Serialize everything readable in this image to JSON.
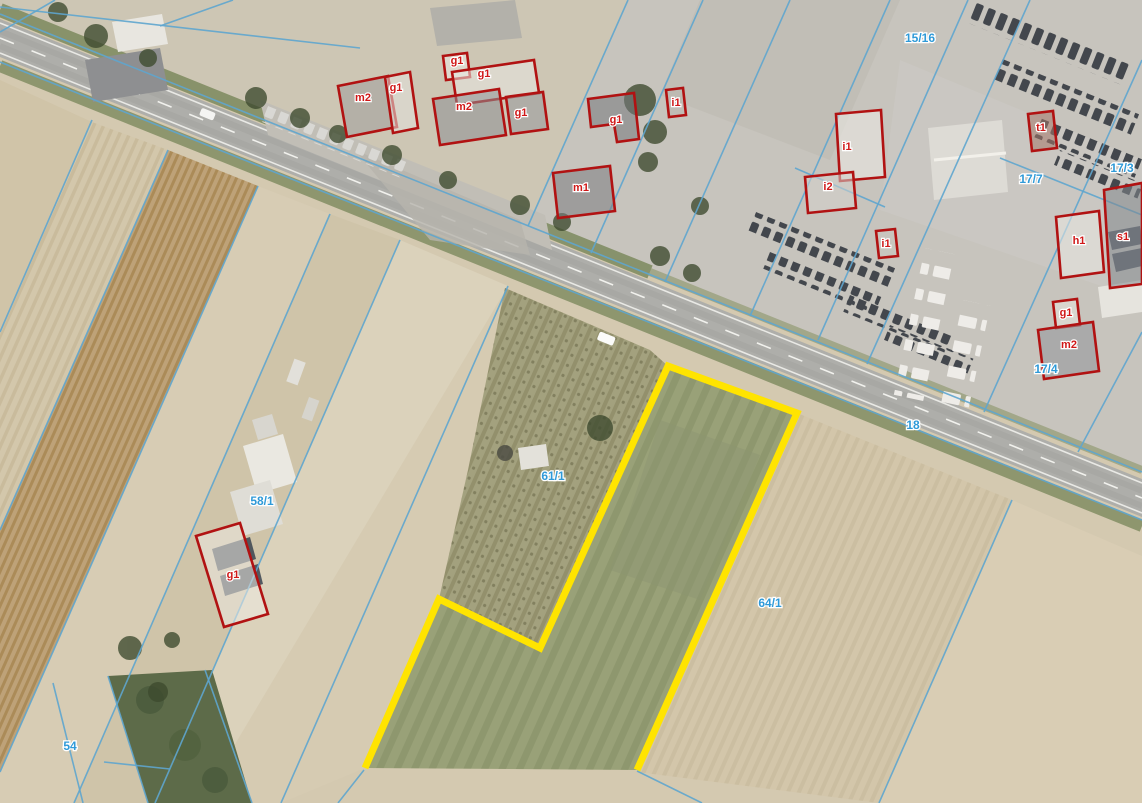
{
  "map": {
    "colors": {
      "parcel_line_blue": "#5fa6cf",
      "parcel_label_blue": "#2f9ad8",
      "building_outline_red": "#b11212",
      "building_label_red": "#d01818",
      "highlight_yellow": "#ffe400"
    },
    "parcel_labels": [
      {
        "text": "15/16",
        "x": 920,
        "y": 42
      },
      {
        "text": "17/7",
        "x": 1031,
        "y": 183
      },
      {
        "text": "17/3",
        "x": 1122,
        "y": 172
      },
      {
        "text": "17/4",
        "x": 1046,
        "y": 373
      },
      {
        "text": "18",
        "x": 913,
        "y": 429
      },
      {
        "text": "58/1",
        "x": 262,
        "y": 505
      },
      {
        "text": "61/1",
        "x": 553,
        "y": 480
      },
      {
        "text": "64/1",
        "x": 770,
        "y": 607
      },
      {
        "text": "54",
        "x": 70,
        "y": 750
      }
    ],
    "buildings": [
      {
        "label": "m2",
        "points": "338,86 388,76 397,127 347,137",
        "lx": 363,
        "ly": 101,
        "roof": "#a09f9d"
      },
      {
        "label": "g1",
        "points": "385,77 410,72 418,128 393,133",
        "lx": 396,
        "ly": 91,
        "roof": "#e4e2dc"
      },
      {
        "label": "g1",
        "points": "443,56 467,53 470,77 446,80",
        "lx": 457,
        "ly": 64,
        "roof": "#eceae4"
      },
      {
        "label": "g1",
        "points": "452,72 534,60 539,93 457,105",
        "lx": 484,
        "ly": 77,
        "roof": "#e9e7e1"
      },
      {
        "label": "m2",
        "points": "433,99 499,89 506,135 440,145",
        "lx": 464,
        "ly": 110,
        "roof": "#8e9093"
      },
      {
        "label": "g1",
        "points": "506,97 543,92 548,129 511,134",
        "lx": 521,
        "ly": 116,
        "roof": "#97999c"
      },
      {
        "label": "g1",
        "points": "588,99 634,93 639,139 617,142 614,124 591,127",
        "lx": 616,
        "ly": 123,
        "roof": "#75787c"
      },
      {
        "label": "m1",
        "points": "553,173 610,166 615,211 558,218",
        "lx": 581,
        "ly": 191,
        "roof": "#7b7e82"
      },
      {
        "label": "i1",
        "points": "666,90 683,88 686,115 669,117",
        "lx": 676,
        "ly": 106,
        "roof": "#b9b6af"
      },
      {
        "label": "i1",
        "points": "836,114 881,110 885,177 840,181",
        "lx": 847,
        "ly": 150,
        "roof": "#edebe6"
      },
      {
        "label": "i2",
        "points": "805,177 853,172 856,208 808,213",
        "lx": 828,
        "ly": 190,
        "roof": "#d4d2cc"
      },
      {
        "label": "i1",
        "points": "876,231 895,229 898,256 879,258",
        "lx": 886,
        "ly": 247,
        "roof": "#c9c6bf"
      },
      {
        "label": "t1",
        "points": "1028,114 1053,111 1057,148 1032,151",
        "lx": 1041,
        "ly": 131,
        "roof": "#a4766a"
      },
      {
        "label": "h1",
        "points": "1056,217 1099,211 1104,272 1061,278",
        "lx": 1079,
        "ly": 244,
        "roof": "#e9e7e2"
      },
      {
        "label": "s1",
        "points": "1104,190 1142,183 1142,284 1110,288",
        "lx": 1123,
        "ly": 240,
        "roof": "#82868d"
      },
      {
        "label": "g1",
        "points": "1053,302 1077,299 1080,325 1056,328",
        "lx": 1066,
        "ly": 316,
        "roof": "#e7e5df"
      },
      {
        "label": "m2",
        "points": "1038,330 1093,322 1099,371 1044,379",
        "lx": 1069,
        "ly": 348,
        "roof": "#92959a"
      },
      {
        "label": "g1",
        "points": "196,536 240,523 268,614 224,627",
        "lx": 233,
        "ly": 578,
        "roof": "#ece9e2"
      }
    ],
    "parcel_lines": [
      [
        0,
        14,
        1142,
        472
      ],
      [
        0,
        62,
        1142,
        520
      ],
      [
        55,
        0,
        0,
        32
      ],
      [
        233,
        0,
        160,
        26
      ],
      [
        0,
        7,
        360,
        48
      ],
      [
        92,
        120,
        0,
        332
      ],
      [
        168,
        150,
        0,
        530
      ],
      [
        258,
        186,
        0,
        772
      ],
      [
        330,
        214,
        74,
        803
      ],
      [
        400,
        240,
        155,
        803
      ],
      [
        508,
        286,
        281,
        803
      ],
      [
        628,
        0,
        528,
        226
      ],
      [
        703,
        0,
        591,
        253
      ],
      [
        790,
        0,
        665,
        282
      ],
      [
        890,
        0,
        750,
        316
      ],
      [
        968,
        0,
        818,
        340
      ],
      [
        1030,
        0,
        867,
        364
      ],
      [
        1142,
        60,
        984,
        412
      ],
      [
        1142,
        332,
        1078,
        452
      ],
      [
        795,
        168,
        885,
        207
      ],
      [
        1000,
        158,
        1142,
        215
      ],
      [
        1012,
        500,
        879,
        803
      ],
      [
        637,
        771,
        702,
        803
      ],
      [
        364,
        770,
        338,
        803
      ],
      [
        53,
        683,
        83,
        803
      ],
      [
        108,
        676,
        148,
        803
      ],
      [
        205,
        670,
        252,
        803
      ],
      [
        104,
        762,
        170,
        769
      ]
    ],
    "highlight_parcel": {
      "points": "365,768 439,599 540,648 668,366 797,413 637,770",
      "color": "#ffe400",
      "stroke_width": 7
    }
  }
}
